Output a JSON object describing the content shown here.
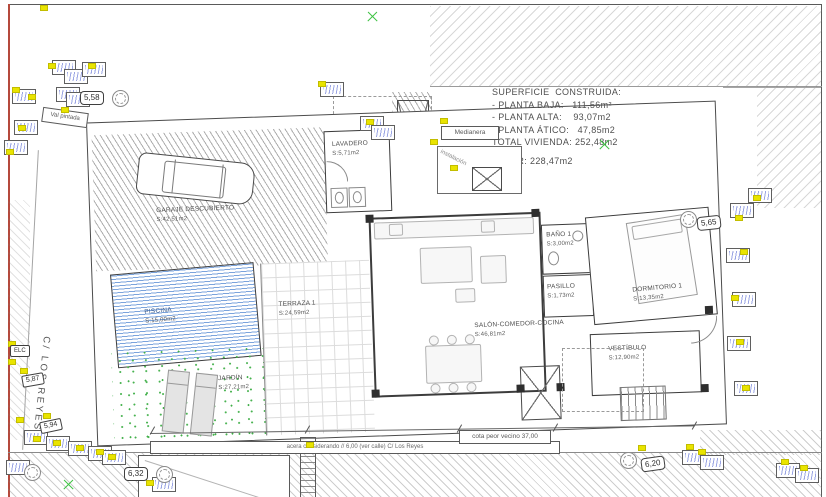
{
  "drawing": {
    "summary": {
      "heading": "SUPERFICIE  CONSTRUIDA:",
      "planta_baja": "- PLANTA BAJA:   111,56m²",
      "planta_alta": "- PLANTA ALTA:    93,07m2",
      "planta_atico": "- PLANTA ÁTICO:   47,85m2",
      "total_vivienda": "TOTAL VIVIENDA: 252,48m2",
      "solar": "SOLAR: 228,47m2"
    },
    "rooms": {
      "lavadero": {
        "name": "LAVADERO",
        "area": "S:5,71m2"
      },
      "garaje": {
        "name": "GARAJE DESCUBIERTO",
        "area": "S:42,51m2"
      },
      "piscina": {
        "name": "PISCINA",
        "area": "S:15,00m2"
      },
      "jardin": {
        "name": "JARDÍN",
        "area": "S:27,21m2"
      },
      "terraza": {
        "name": "TERRAZA 1",
        "area": "S:24,59m2"
      },
      "salon": {
        "name": "SALÓN-COMEDOR-COCINA",
        "area": "S:46,81m2"
      },
      "bano": {
        "name": "BAÑO 1",
        "area": "S:3,00m2"
      },
      "pasillo": {
        "name": "PASILLO",
        "area": "S:1,73m2"
      },
      "dormitorio": {
        "name": "DORMITORIO 1",
        "area": "S:13,35m2"
      },
      "vestibulo": {
        "name": "VESTÍBULO",
        "area": "S:12,90m2"
      }
    },
    "street": "C/ LOS REYES",
    "levels": {
      "l558": "5,58",
      "l565": "5,65",
      "l632": "6,32",
      "l620": "6,20",
      "l587": "5,87",
      "l594": "5,94",
      "elc": "ELC"
    },
    "notes": {
      "medianera": "Medianera",
      "instalacion": "instalación",
      "val_pintada": "Val pintada",
      "acera": "acera considerando // 6,00 (ver calle) C/ Los Reyes",
      "cota": "cota peor vecino 37,00"
    },
    "colors": {
      "highlight_yellow": "#e9e400",
      "pool_blue": "#7aa3dc",
      "garden_green": "#46b24e",
      "survey_cross_green": "#3fc244",
      "frame_red": "#b5493c"
    }
  }
}
